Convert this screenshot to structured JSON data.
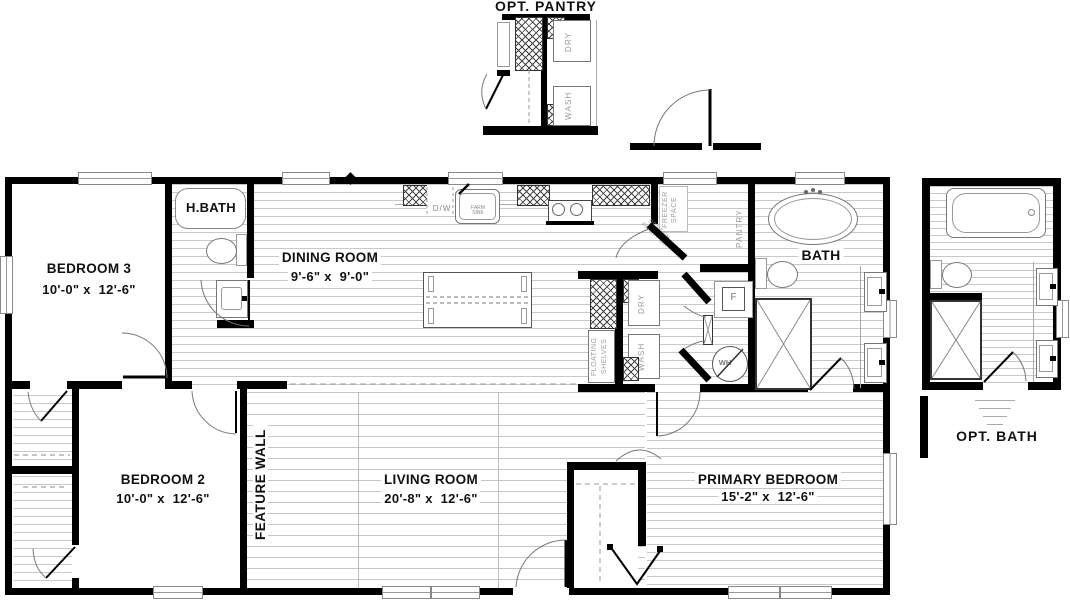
{
  "details": {
    "opt_pantry_label": "OPT. PANTRY",
    "opt_bath_label": "OPT. BATH"
  },
  "rooms": {
    "bedroom3": {
      "name": "BEDROOM 3",
      "dims": "10'-0\" x  12'-6\""
    },
    "bedroom2": {
      "name": "BEDROOM 2",
      "dims": "10'-0\" x  12'-6\""
    },
    "dining": {
      "name": "DINING ROOM",
      "dims": "9'-6\" x  9'-0\""
    },
    "living": {
      "name": "LIVING ROOM",
      "dims": "20'-8\" x  12'-6\""
    },
    "primary": {
      "name": "PRIMARY BEDROOM",
      "dims": "15'-2\" x  12'-6\""
    },
    "h_bath": {
      "name": "H.BATH"
    },
    "bath": {
      "name": "BATH"
    }
  },
  "annotations": {
    "feature_wall": "FEATURE WALL",
    "freezer_space": "FREEZER SPACE",
    "pantry": "PANTRY",
    "screen_pantry_door": "SCREEN PNTRY DR",
    "floating_shelves": "FLOATING SHELVES"
  },
  "appliances": {
    "dryer": "DRY",
    "washer": "WASH",
    "pantry_dryer": "DRY",
    "pantry_washer": "WASH",
    "dishwasher": "D/W",
    "farm_sink": "FARM SINK",
    "furnace": "F",
    "water_heater": "WH"
  },
  "colors": {
    "wall": "#000000",
    "floor_line": "#c8c8c8",
    "annotation_gray": "#9b9b9b"
  }
}
